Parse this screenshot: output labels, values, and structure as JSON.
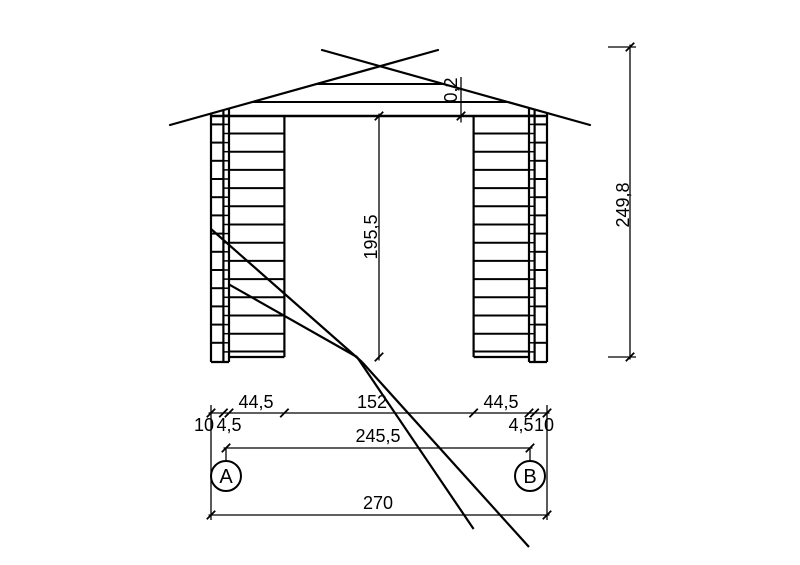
{
  "colors": {
    "line": "#000000",
    "background": "#ffffff"
  },
  "drawing": {
    "type": "front-elevation",
    "dims": {
      "roof_gap": "0,2",
      "opening_height": "195,5",
      "total_height": "249,8",
      "left_wall": "44,5",
      "opening_width": "152",
      "right_wall": "44,5",
      "left_end_log": "10",
      "left_joint": "4,5",
      "span_inner": "245,5",
      "right_joint": "4,5",
      "right_end_log": "10",
      "total_width": "270"
    },
    "axes": {
      "left": "A",
      "right": "B"
    }
  }
}
